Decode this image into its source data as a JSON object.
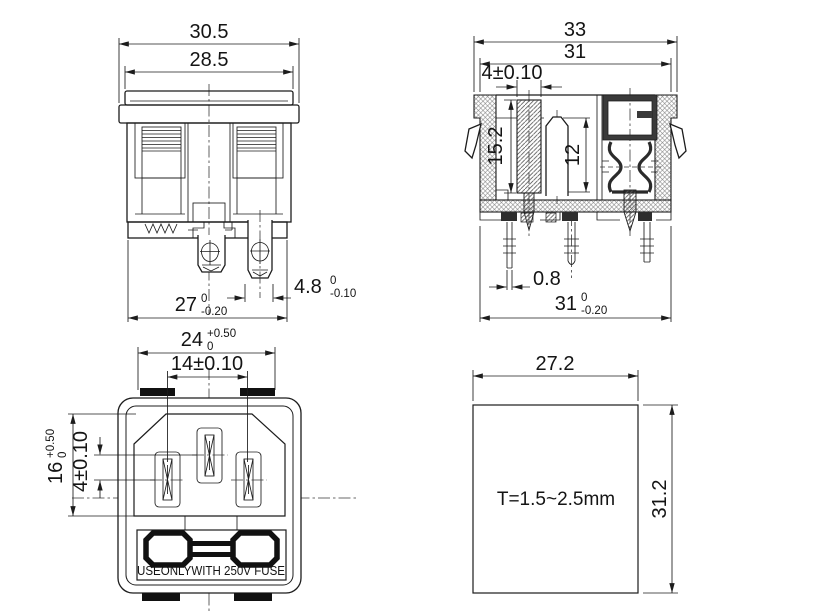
{
  "palette": {
    "background": "#ffffff",
    "ink": "#1c1c1c"
  },
  "views": {
    "front_view": {
      "overall_width": "30.5",
      "cap_width": "28.5",
      "lower_width": {
        "value": "27",
        "upper": "0",
        "lower": "-0.20"
      },
      "terminal_width": {
        "value": "4.8",
        "upper": "0",
        "lower": "-0.10"
      }
    },
    "side_view": {
      "overall_width": "33",
      "body_width": "31",
      "earth_pin_width": "4±0.10",
      "cavity_depth": "15.2",
      "contact_height": "12",
      "pin_thickness": "0.8",
      "pin_span": {
        "value": "31",
        "upper": "0",
        "lower": "-0.20"
      }
    },
    "face_view": {
      "opening_width": {
        "value": "24",
        "upper": "+0.50",
        "lower": "0"
      },
      "pin_pitch": "14±0.10",
      "opening_height": {
        "value": "16",
        "upper": "+0.50",
        "lower": "0"
      },
      "earth_pin_offset": "4±0.10",
      "fuse_marking": "USEONLYWITH 250V FUSE"
    },
    "panel_cutout": {
      "width": "27.2",
      "height": "31.2",
      "thickness_note": "T=1.5~2.5mm"
    }
  }
}
